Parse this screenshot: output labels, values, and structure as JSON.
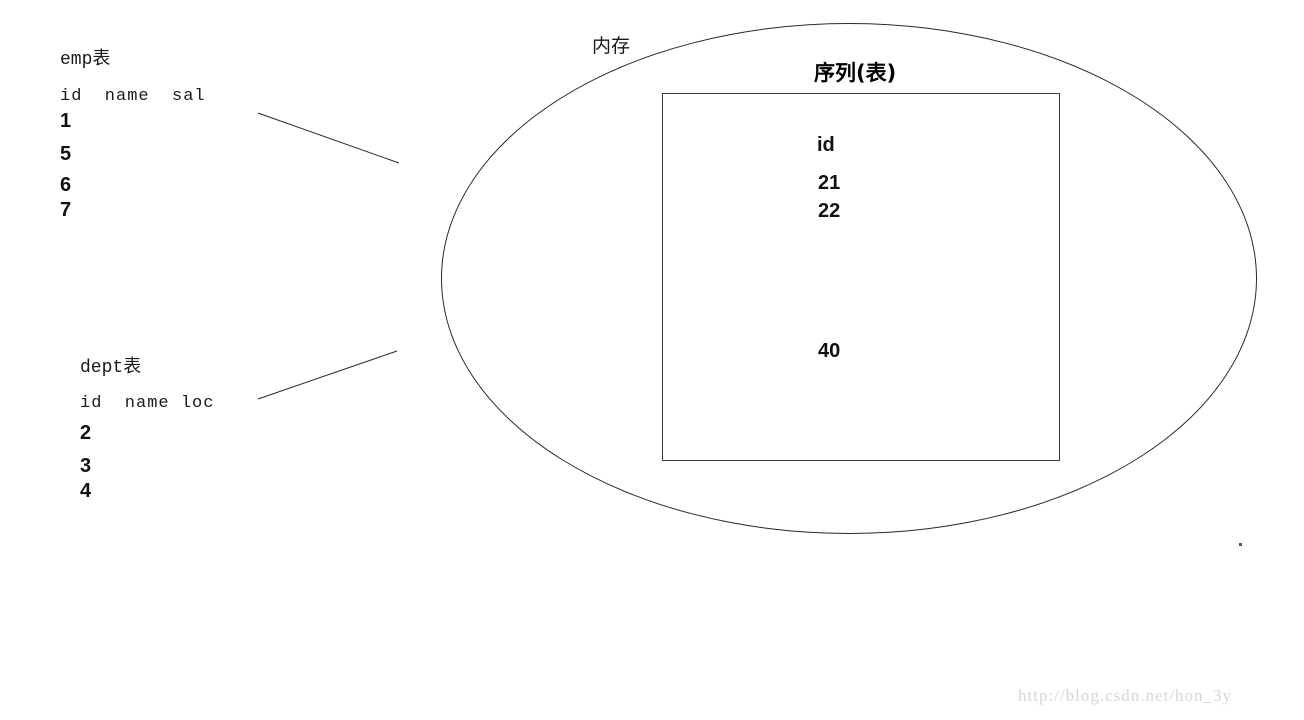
{
  "emp_table": {
    "title": "emp表",
    "header": "id  name  sal",
    "rows": [
      "1",
      "5",
      "6",
      "7"
    ]
  },
  "dept_table": {
    "title": "dept表",
    "header": "id  name loc",
    "rows": [
      "2",
      "3",
      "4"
    ]
  },
  "memory": {
    "label": "内存"
  },
  "sequence_table": {
    "title": "序列(表)",
    "column_header": "id",
    "values": [
      "21",
      "22",
      "40"
    ]
  },
  "watermark": {
    "text": "http://blog.csdn.net/hon_3y"
  },
  "colors": {
    "ink": "#1a1a1a",
    "background": "#ffffff",
    "watermark": "#d6d6d6"
  }
}
